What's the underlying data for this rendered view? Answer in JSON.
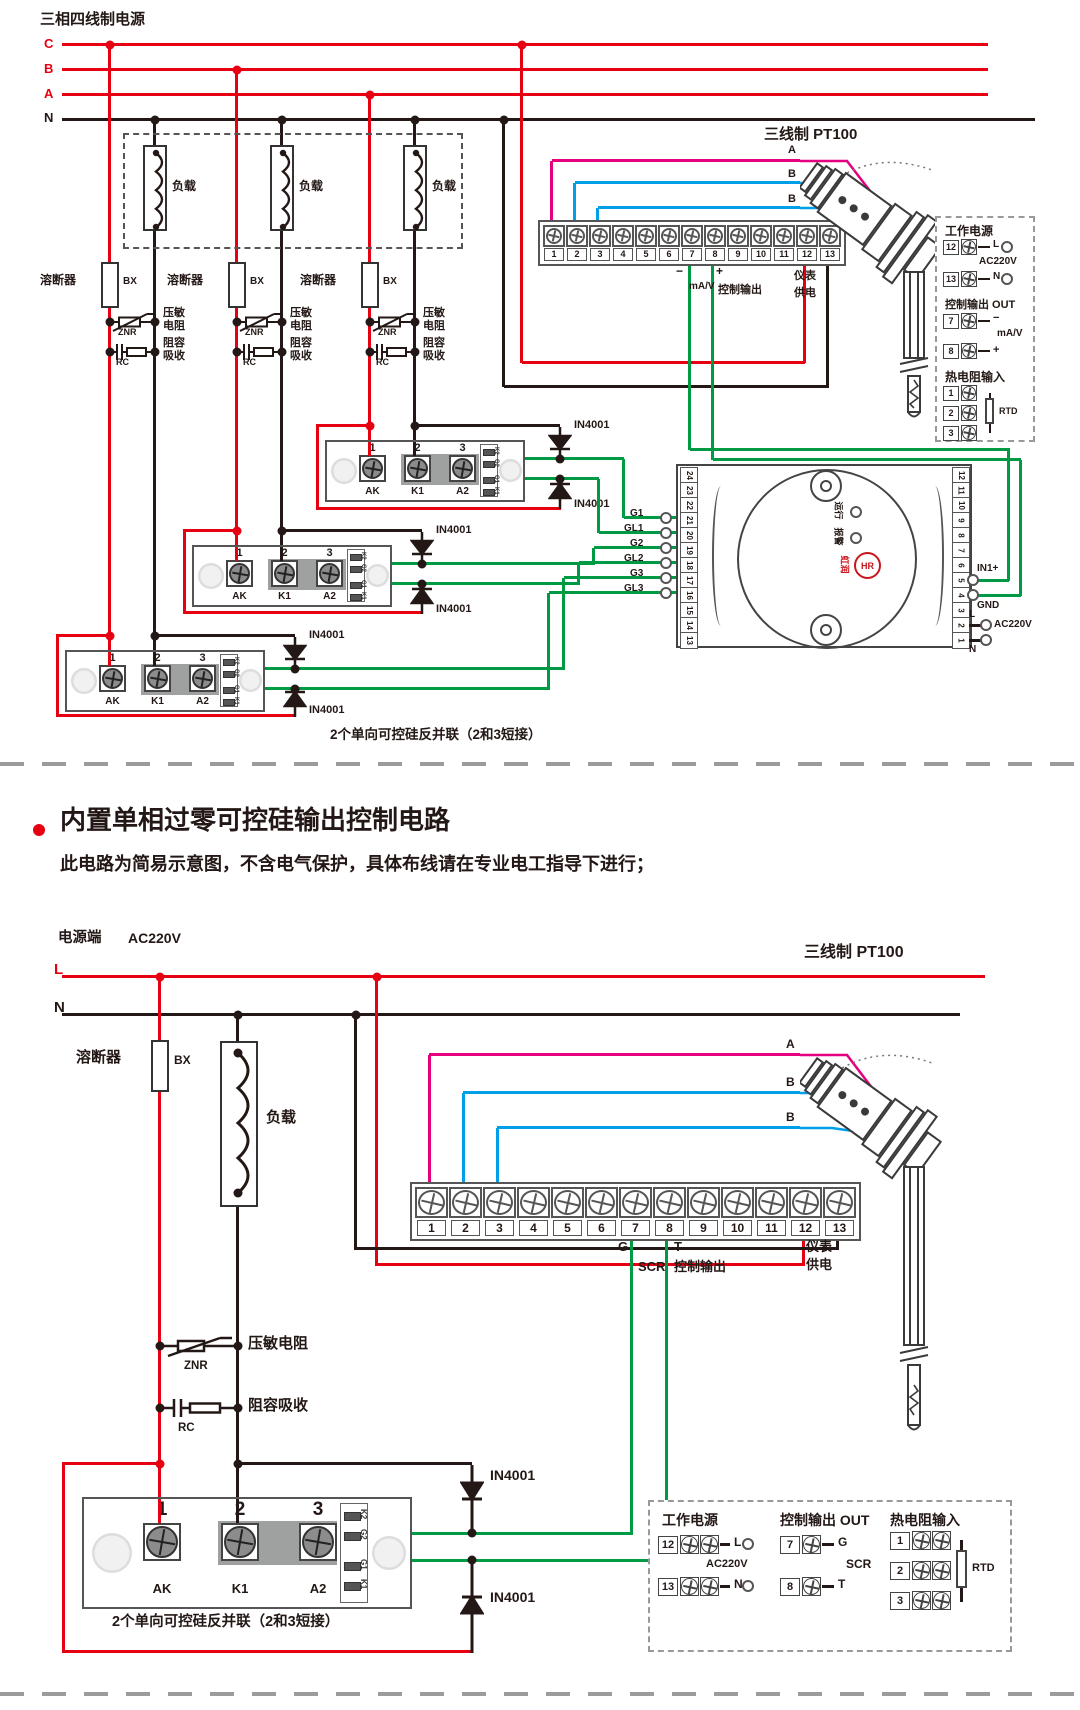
{
  "top": {
    "title": "三相四线制电源",
    "phases": [
      "C",
      "B",
      "A"
    ],
    "neutral": "N",
    "load": "负载",
    "fuse": "溶断器",
    "fuse_tag": "BX",
    "varistor_line1": "压敏",
    "varistor_line2": "电阻",
    "varistor_tag": "ZNR",
    "snubber_line1": "阻容",
    "snubber_line2": "吸收",
    "snubber_tag": "RC",
    "diode": "IN4001",
    "terminals": [
      "1",
      "2",
      "3",
      "4",
      "5",
      "6",
      "7",
      "8",
      "9",
      "10",
      "11",
      "12",
      "13"
    ],
    "out_minus": "−",
    "out_plus": "+",
    "out_unit": "mA/V",
    "out_label": "控制输出",
    "meter_line1": "仪表",
    "meter_line2": "供电",
    "sensor_wires": [
      "A",
      "B",
      "B"
    ],
    "sensor_title": "三线制 PT100",
    "gates": [
      "G1",
      "GL1",
      "G2",
      "GL2",
      "G3",
      "GL3"
    ],
    "caption": "2个单向可控硅反并联（2和3短接）"
  },
  "scr": {
    "n1": "1",
    "n2": "2",
    "n3": "3",
    "p1": "AK",
    "p2": "K1",
    "p3": "A2",
    "s1": "K2",
    "s2": "G2",
    "s3": "G1",
    "s4": "K1"
  },
  "legend_top": {
    "power_title": "工作电源",
    "t12": "12",
    "t13": "13",
    "l": "L",
    "n": "N",
    "ac": "AC220V",
    "out_title": "控制输出 OUT",
    "t7": "7",
    "t8": "8",
    "minus": "−",
    "plus": "+",
    "unit": "mA/V",
    "rtd_title": "热电阻输入",
    "r1": "1",
    "r2": "2",
    "r3": "3",
    "rtd": "RTD"
  },
  "controller": {
    "left_terminals": [
      "24",
      "23",
      "22",
      "21",
      "20",
      "19",
      "18",
      "17",
      "16",
      "15",
      "14",
      "13"
    ],
    "right_terminals": [
      "12",
      "11",
      "10",
      "9",
      "8",
      "7",
      "6",
      "5",
      "4",
      "3",
      "2",
      "1"
    ],
    "in1": "IN1+",
    "gnd": "GND",
    "l": "L",
    "ac": "AC220V",
    "n": "N",
    "led1": "运行",
    "led2": "报警",
    "brand": "虹润",
    "brand_logo": "HR"
  },
  "section": {
    "title": "内置单相过零可控硅输出控制电路",
    "subtitle": "此电路为简易示意图，不含电气保护，具体布线请在专业电工指导下进行；"
  },
  "bottom": {
    "source_label": "电源端",
    "source_value": "AC220V",
    "live": "L",
    "neutral": "N",
    "fuse": "溶断器",
    "fuse_tag": "BX",
    "load": "负载",
    "varistor": "压敏电阻",
    "varistor_tag": "ZNR",
    "snubber": "阻容吸收",
    "snubber_tag": "RC",
    "diode": "IN4001",
    "terminals": [
      "1",
      "2",
      "3",
      "4",
      "5",
      "6",
      "7",
      "8",
      "9",
      "10",
      "11",
      "12",
      "13"
    ],
    "out_g": "G",
    "out_t": "T",
    "out_scr": "SCR",
    "out_label": "控制输出",
    "meter_line1": "仪表",
    "meter_line2": "供电",
    "sensor_wires": [
      "A",
      "B",
      "B"
    ],
    "sensor_title": "三线制 PT100",
    "caption": "2个单向可控硅反并联（2和3短接）"
  },
  "legend_bottom": {
    "power_title": "工作电源",
    "t12": "12",
    "t13": "13",
    "l": "L",
    "n": "N",
    "ac": "AC220V",
    "out_title": "控制输出 OUT",
    "t7": "7",
    "t8": "8",
    "g": "G",
    "t": "T",
    "scr": "SCR",
    "rtd_title": "热电阻输入",
    "r1": "1",
    "r2": "2",
    "r3": "3",
    "rtd": "RTD"
  },
  "colors": {
    "phase_red": "#e60012",
    "neutral_black": "#231815",
    "wire_green": "#009944",
    "wire_magenta": "#e4007f",
    "wire_blue": "#00a0e9"
  }
}
